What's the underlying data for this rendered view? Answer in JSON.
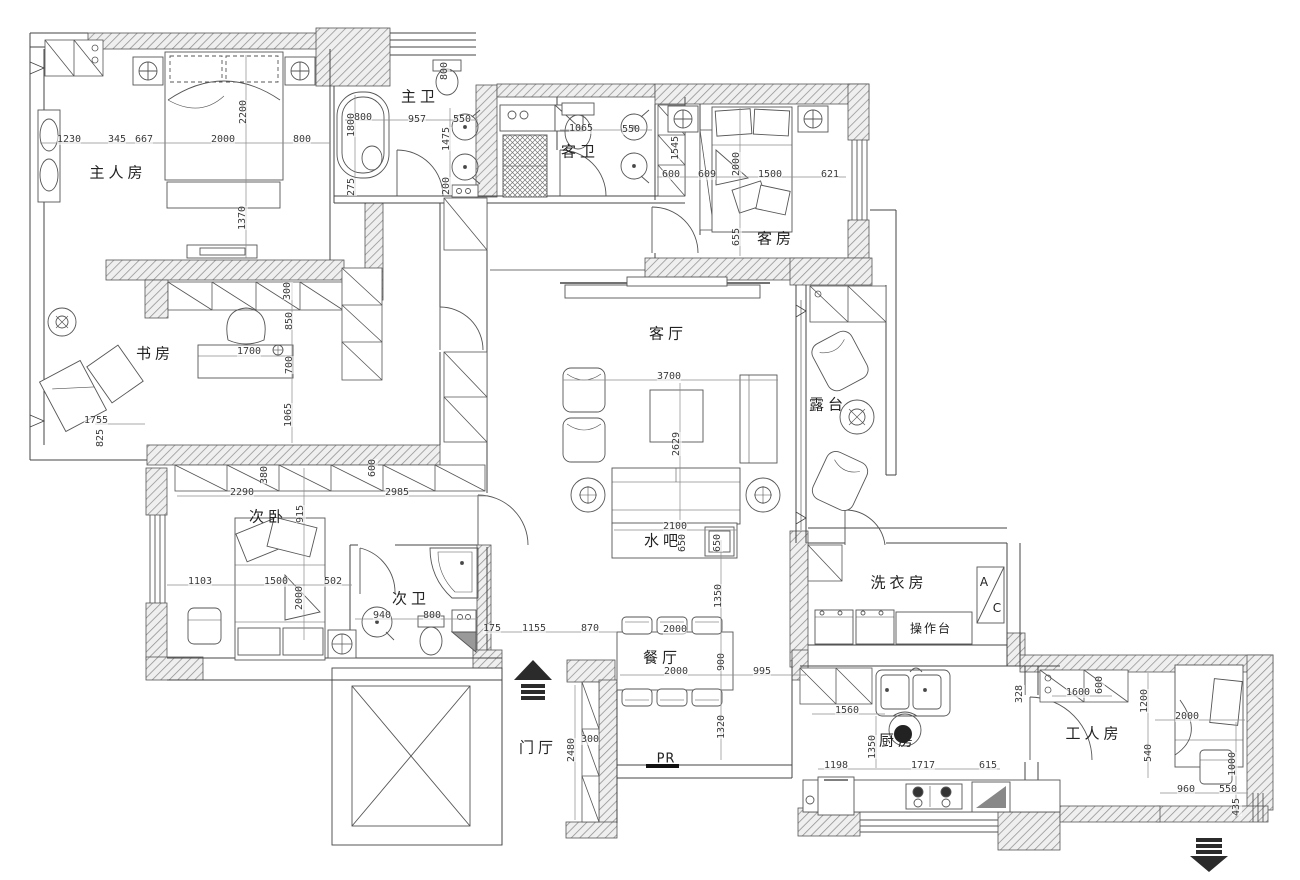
{
  "drawing": {
    "type_label": "apartment floor plan"
  },
  "colors": {
    "line": "#3f3f3f",
    "hatch": "#8a8a8a",
    "dim_text": "#3a3a3a",
    "arrow": "#2b2b2b",
    "bg": "#ffffff"
  },
  "rooms": [
    {
      "id": "master-bedroom",
      "label": "主人房",
      "x": 118,
      "y": 172
    },
    {
      "id": "master-bath",
      "label": "主卫",
      "x": 420,
      "y": 96
    },
    {
      "id": "guest-bath",
      "label": "客卫",
      "x": 580,
      "y": 151
    },
    {
      "id": "guest-room",
      "label": "客房",
      "x": 776,
      "y": 238
    },
    {
      "id": "study",
      "label": "书房",
      "x": 155,
      "y": 353
    },
    {
      "id": "living-room",
      "label": "客厅",
      "x": 668,
      "y": 333
    },
    {
      "id": "terrace",
      "label": "露台",
      "x": 828,
      "y": 404
    },
    {
      "id": "second-bedroom",
      "label": "次卧",
      "x": 268,
      "y": 516
    },
    {
      "id": "second-bath",
      "label": "次卫",
      "x": 411,
      "y": 598
    },
    {
      "id": "water-bar",
      "label": "水吧",
      "x": 663,
      "y": 540
    },
    {
      "id": "dining-room",
      "label": "餐厅",
      "x": 662,
      "y": 657
    },
    {
      "id": "entrance-hall",
      "label": "门厅",
      "x": 538,
      "y": 747
    },
    {
      "id": "laundry-room",
      "label": "洗衣房",
      "x": 899,
      "y": 582
    },
    {
      "id": "kitchen",
      "label": "厨房",
      "x": 898,
      "y": 740
    },
    {
      "id": "maid-room",
      "label": "工人房",
      "x": 1094,
      "y": 733
    }
  ],
  "annotations": [
    {
      "name": "counter-label",
      "text": "操作台",
      "x": 931,
      "y": 628,
      "cls": "ann-label"
    },
    {
      "name": "pr-label",
      "text": "PR",
      "x": 666,
      "y": 759,
      "cls": "ann-label big"
    },
    {
      "name": "ac-letter-a",
      "text": "A",
      "x": 984,
      "y": 582,
      "cls": "ann-label ac"
    },
    {
      "name": "ac-letter-c",
      "text": "C",
      "x": 997,
      "y": 608,
      "cls": "ann-label ac"
    }
  ],
  "dimensions": [
    {
      "v": "1230",
      "x": 69,
      "y": 140
    },
    {
      "v": "345",
      "x": 117,
      "y": 140
    },
    {
      "v": "667",
      "x": 144,
      "y": 140
    },
    {
      "v": "2000",
      "x": 223,
      "y": 140
    },
    {
      "v": "800",
      "x": 302,
      "y": 140
    },
    {
      "v": "2200",
      "x": 244,
      "y": 112,
      "r": 1
    },
    {
      "v": "1370",
      "x": 243,
      "y": 218,
      "r": 1
    },
    {
      "v": "800",
      "x": 445,
      "y": 71,
      "r": 1
    },
    {
      "v": "1800",
      "x": 352,
      "y": 125,
      "r": 1
    },
    {
      "v": "800",
      "x": 363,
      "y": 118
    },
    {
      "v": "957",
      "x": 417,
      "y": 120
    },
    {
      "v": "550",
      "x": 462,
      "y": 120
    },
    {
      "v": "1475",
      "x": 447,
      "y": 139,
      "r": 1
    },
    {
      "v": "200",
      "x": 447,
      "y": 186,
      "r": 1
    },
    {
      "v": "275",
      "x": 352,
      "y": 187,
      "r": 1
    },
    {
      "v": "1065",
      "x": 581,
      "y": 129
    },
    {
      "v": "550",
      "x": 631,
      "y": 130
    },
    {
      "v": "1545",
      "x": 676,
      "y": 148,
      "r": 1
    },
    {
      "v": "600",
      "x": 671,
      "y": 175
    },
    {
      "v": "609",
      "x": 707,
      "y": 175
    },
    {
      "v": "1500",
      "x": 770,
      "y": 175
    },
    {
      "v": "621",
      "x": 830,
      "y": 175
    },
    {
      "v": "2000",
      "x": 737,
      "y": 164,
      "r": 1
    },
    {
      "v": "655",
      "x": 737,
      "y": 237,
      "r": 1
    },
    {
      "v": "1755",
      "x": 96,
      "y": 421
    },
    {
      "v": "825",
      "x": 101,
      "y": 438,
      "r": 1
    },
    {
      "v": "300",
      "x": 288,
      "y": 291,
      "r": 1
    },
    {
      "v": "850",
      "x": 290,
      "y": 321,
      "r": 1
    },
    {
      "v": "1700",
      "x": 249,
      "y": 352
    },
    {
      "v": "700",
      "x": 290,
      "y": 365,
      "r": 1
    },
    {
      "v": "1065",
      "x": 289,
      "y": 415,
      "r": 1
    },
    {
      "v": "2290",
      "x": 242,
      "y": 493
    },
    {
      "v": "2985",
      "x": 397,
      "y": 493
    },
    {
      "v": "915",
      "x": 301,
      "y": 514,
      "r": 1
    },
    {
      "v": "380",
      "x": 265,
      "y": 475,
      "r": 1
    },
    {
      "v": "600",
      "x": 373,
      "y": 468,
      "r": 1
    },
    {
      "v": "1103",
      "x": 200,
      "y": 582
    },
    {
      "v": "1500",
      "x": 276,
      "y": 582
    },
    {
      "v": "502",
      "x": 333,
      "y": 582
    },
    {
      "v": "2000",
      "x": 300,
      "y": 598,
      "r": 1
    },
    {
      "v": "940",
      "x": 382,
      "y": 616
    },
    {
      "v": "800",
      "x": 432,
      "y": 616
    },
    {
      "v": "3700",
      "x": 669,
      "y": 377
    },
    {
      "v": "2629",
      "x": 677,
      "y": 444,
      "r": 1
    },
    {
      "v": "2100",
      "x": 675,
      "y": 527
    },
    {
      "v": "650",
      "x": 683,
      "y": 543,
      "r": 1
    },
    {
      "v": "650",
      "x": 718,
      "y": 543,
      "r": 1
    },
    {
      "v": "1350",
      "x": 719,
      "y": 596,
      "r": 1
    },
    {
      "v": "175",
      "x": 492,
      "y": 629
    },
    {
      "v": "1155",
      "x": 534,
      "y": 629
    },
    {
      "v": "870",
      "x": 590,
      "y": 629
    },
    {
      "v": "2000",
      "x": 675,
      "y": 630
    },
    {
      "v": "2000",
      "x": 676,
      "y": 672
    },
    {
      "v": "900",
      "x": 722,
      "y": 662,
      "r": 1
    },
    {
      "v": "995",
      "x": 762,
      "y": 672
    },
    {
      "v": "1320",
      "x": 722,
      "y": 727,
      "r": 1
    },
    {
      "v": "300",
      "x": 590,
      "y": 740
    },
    {
      "v": "2480",
      "x": 572,
      "y": 750,
      "r": 1
    },
    {
      "v": "1560",
      "x": 847,
      "y": 711
    },
    {
      "v": "1350",
      "x": 873,
      "y": 747,
      "r": 1
    },
    {
      "v": "1198",
      "x": 836,
      "y": 766
    },
    {
      "v": "1717",
      "x": 923,
      "y": 766
    },
    {
      "v": "615",
      "x": 988,
      "y": 766
    },
    {
      "v": "328",
      "x": 1020,
      "y": 694,
      "r": 1
    },
    {
      "v": "1600",
      "x": 1078,
      "y": 693
    },
    {
      "v": "600",
      "x": 1100,
      "y": 685,
      "r": 1
    },
    {
      "v": "1200",
      "x": 1145,
      "y": 701,
      "r": 1
    },
    {
      "v": "2000",
      "x": 1187,
      "y": 717
    },
    {
      "v": "540",
      "x": 1149,
      "y": 753,
      "r": 1
    },
    {
      "v": "1000",
      "x": 1233,
      "y": 764,
      "r": 1
    },
    {
      "v": "960",
      "x": 1186,
      "y": 790
    },
    {
      "v": "550",
      "x": 1228,
      "y": 790
    },
    {
      "v": "435",
      "x": 1237,
      "y": 807,
      "r": 1
    }
  ],
  "icons": [
    {
      "name": "entrance-arrow-up"
    },
    {
      "name": "exit-arrow-down"
    },
    {
      "name": "elevator"
    },
    {
      "name": "shower-unit"
    },
    {
      "name": "bathtub"
    },
    {
      "name": "ceiling-light-symbol"
    }
  ]
}
